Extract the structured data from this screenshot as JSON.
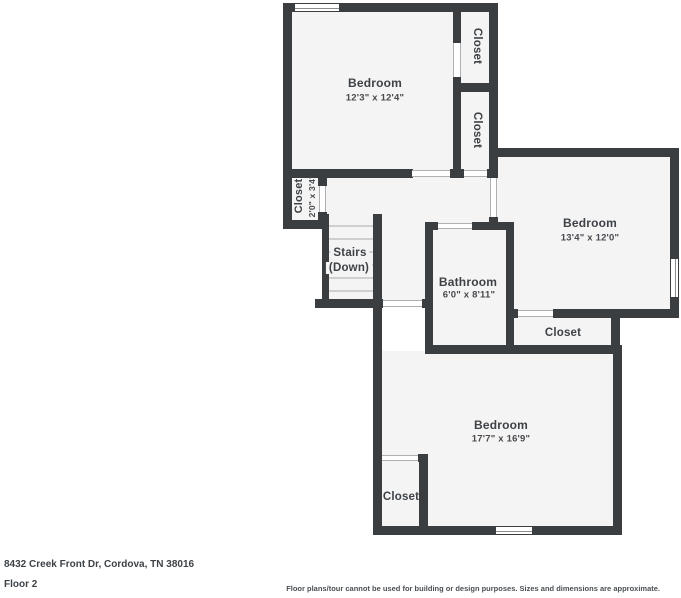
{
  "footer": {
    "address": "8432 Creek Front Dr, Cordova, TN 38016",
    "floor_label": "Floor 2",
    "disclaimer": "Floor plans/tour cannot be used for building or design purposes. Sizes and dimensions are approximate."
  },
  "colors": {
    "wall": "#3b3e40",
    "room_fill": "#f4f4f4",
    "page_bg": "#ffffff",
    "label_text": "#3e4246"
  },
  "rooms": {
    "bedroom_top": {
      "name": "Bedroom",
      "dims": "12'3\" x 12'4\""
    },
    "closet_top_1": {
      "name": "Closet"
    },
    "closet_top_2": {
      "name": "Closet"
    },
    "closet_left": {
      "name": "Closet",
      "dims": "2'0\" x 3'4\""
    },
    "stairs": {
      "name": "Stairs",
      "sub": "(Down)"
    },
    "bathroom": {
      "name": "Bathroom",
      "dims": "6'0\" x 8'11\""
    },
    "bedroom_right": {
      "name": "Bedroom",
      "dims": "13'4\" x 12'0\""
    },
    "closet_right": {
      "name": "Closet"
    },
    "bedroom_bottom": {
      "name": "Bedroom",
      "dims": "17'7\" x 16'9\""
    },
    "closet_bottom": {
      "name": "Closet"
    }
  }
}
